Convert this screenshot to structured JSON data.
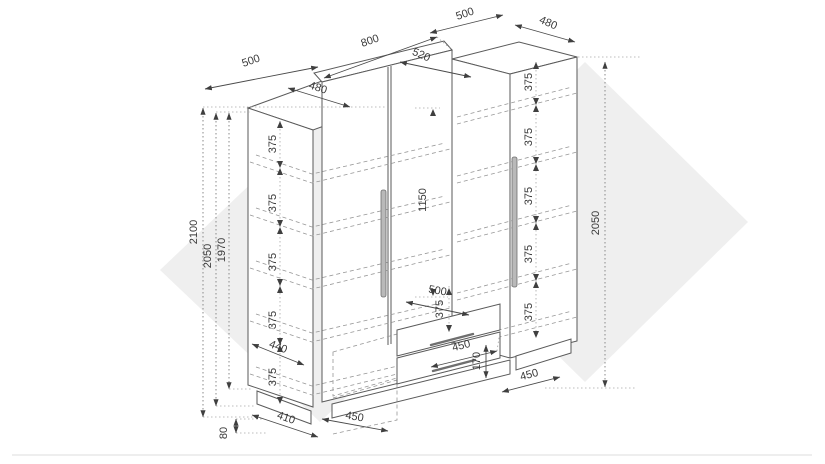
{
  "colors": {
    "background": "#ffffff",
    "line": "#5a5a5a",
    "dimension": "#4a4a4a",
    "hidden_dash": "#979797",
    "watermark": "#efefef",
    "handle": "#b9b9b9"
  },
  "labels": {
    "top_width_left": "500",
    "top_width_middle": "800",
    "top_width_right": "500",
    "top_depth_right": "480",
    "top_depth_middle": "520",
    "top_depth_left": "480",
    "height_total": "2100",
    "height_left_cabinet": "2050",
    "height_left_interior": "1970",
    "height_right_cabinet": "2050",
    "middle_door_height": "1150",
    "shelf_gaps_left": [
      "375",
      "375",
      "375",
      "375",
      "375"
    ],
    "shelf_gaps_right": [
      "375",
      "375",
      "375",
      "375",
      "375"
    ],
    "shelf_gap_middle": "375",
    "shelf_depth": "440",
    "drawer_unit_width": "500",
    "drawer_width": "450",
    "drawer_height": "170",
    "plinth_depth": "410",
    "base_width_middle": "450",
    "base_width_right": "450",
    "plinth_height": "80"
  }
}
